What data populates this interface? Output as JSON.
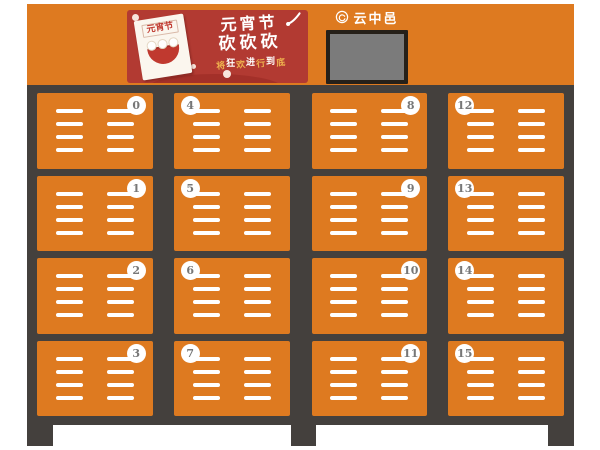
{
  "brand": {
    "name": "云中邑"
  },
  "banner": {
    "poster_label": "元宵节",
    "title_line1": "元宵节",
    "title_line2": "砍砍砍",
    "subtitle": "将狂欢进行到底"
  },
  "lockers": {
    "rows": 4,
    "halves": [
      {
        "columns": [
          {
            "badge_side": "right",
            "door_numbers": [
              0,
              1,
              2,
              3
            ]
          },
          {
            "badge_side": "left",
            "door_numbers": [
              4,
              5,
              6,
              7
            ]
          }
        ]
      },
      {
        "columns": [
          {
            "badge_side": "right",
            "door_numbers": [
              8,
              9,
              10,
              11
            ]
          },
          {
            "badge_side": "left",
            "door_numbers": [
              12,
              13,
              14,
              15
            ]
          }
        ]
      }
    ]
  },
  "colors": {
    "orange": "#de7a20",
    "cabinet_dark": "#44403d",
    "banner_red": "#b23a32",
    "banner_red_dark": "#a33029",
    "gold": "#eeb04e",
    "screen_gray": "#7b7b7b",
    "badge_text": "#777777"
  }
}
